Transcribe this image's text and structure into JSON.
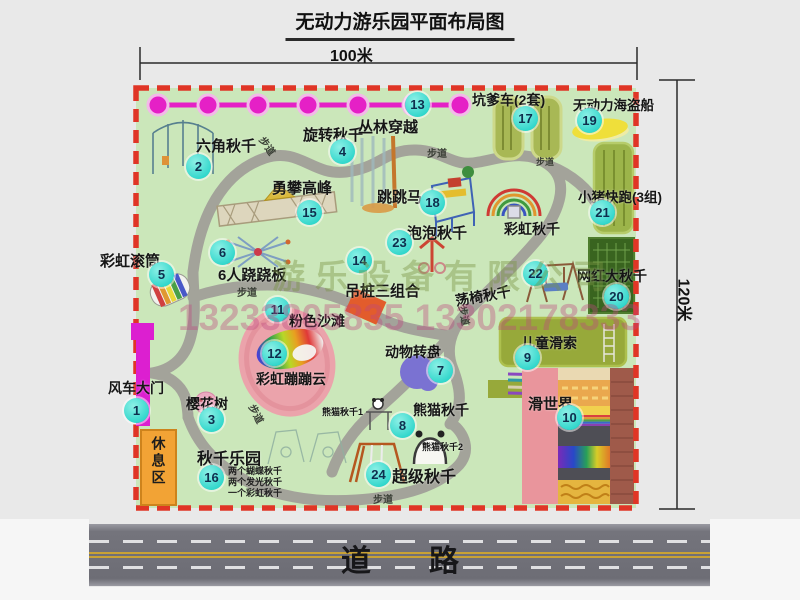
{
  "title": "无动力游乐园平面布局图",
  "dimensions": {
    "width": "100米",
    "height": "120米"
  },
  "road": {
    "label": "道路"
  },
  "rest_area_label": "休息区",
  "walkway_label": "步道",
  "watermark": {
    "company": "游乐设备有限公司",
    "phone": "13233805835 13302178333"
  },
  "colors": {
    "park_green": "#cbe7ba",
    "boundary_red": "#e03526",
    "badge_cyan": "#2fd6cb",
    "gate_magenta": "#e520c6",
    "road_gray": "#6d6d75"
  },
  "attractions": [
    {
      "num": "1",
      "label": "风车大门"
    },
    {
      "num": "2",
      "label": "六角秋千"
    },
    {
      "num": "3",
      "label": "樱花树"
    },
    {
      "num": "4",
      "label": "旋转秋千"
    },
    {
      "num": "5",
      "label": "彩虹滚筒"
    },
    {
      "num": "6",
      "label": "6人跷跷板"
    },
    {
      "num": "7",
      "label": "动物转盘"
    },
    {
      "num": "8",
      "label": "熊猫秋千"
    },
    {
      "num": "9",
      "label": "儿童滑索"
    },
    {
      "num": "10",
      "label": "滑世界"
    },
    {
      "num": "11",
      "label": "粉色沙滩"
    },
    {
      "num": "12",
      "label": "彩虹蹦蹦云"
    },
    {
      "num": "13",
      "label": "丛林穿越"
    },
    {
      "num": "14",
      "label": "吊桩三组合"
    },
    {
      "num": "15",
      "label": "勇攀高峰"
    },
    {
      "num": "16",
      "label": "秋千乐园"
    },
    {
      "num": "17",
      "label": "坑爹车(2套)"
    },
    {
      "num": "18",
      "label": "跳跳马"
    },
    {
      "num": "19",
      "label": "无动力海盗船"
    },
    {
      "num": "20",
      "label": "网红大秋千"
    },
    {
      "num": "21",
      "label": "小猪快跑(3组)"
    },
    {
      "num": "22",
      "label": "荡椅秋千"
    },
    {
      "num": "23",
      "label": "泡泡秋千"
    },
    {
      "num": "24",
      "label": "超级秋千"
    }
  ],
  "extra_labels": {
    "rainbow_swing": "彩虹秋千",
    "panda_swing_1": "熊猫秋千1",
    "panda_swing_2": "熊猫秋千2",
    "swing_park_notes": [
      "两个蝴蝶秋千",
      "两个发光秋千",
      "一个彩虹秋千"
    ]
  }
}
